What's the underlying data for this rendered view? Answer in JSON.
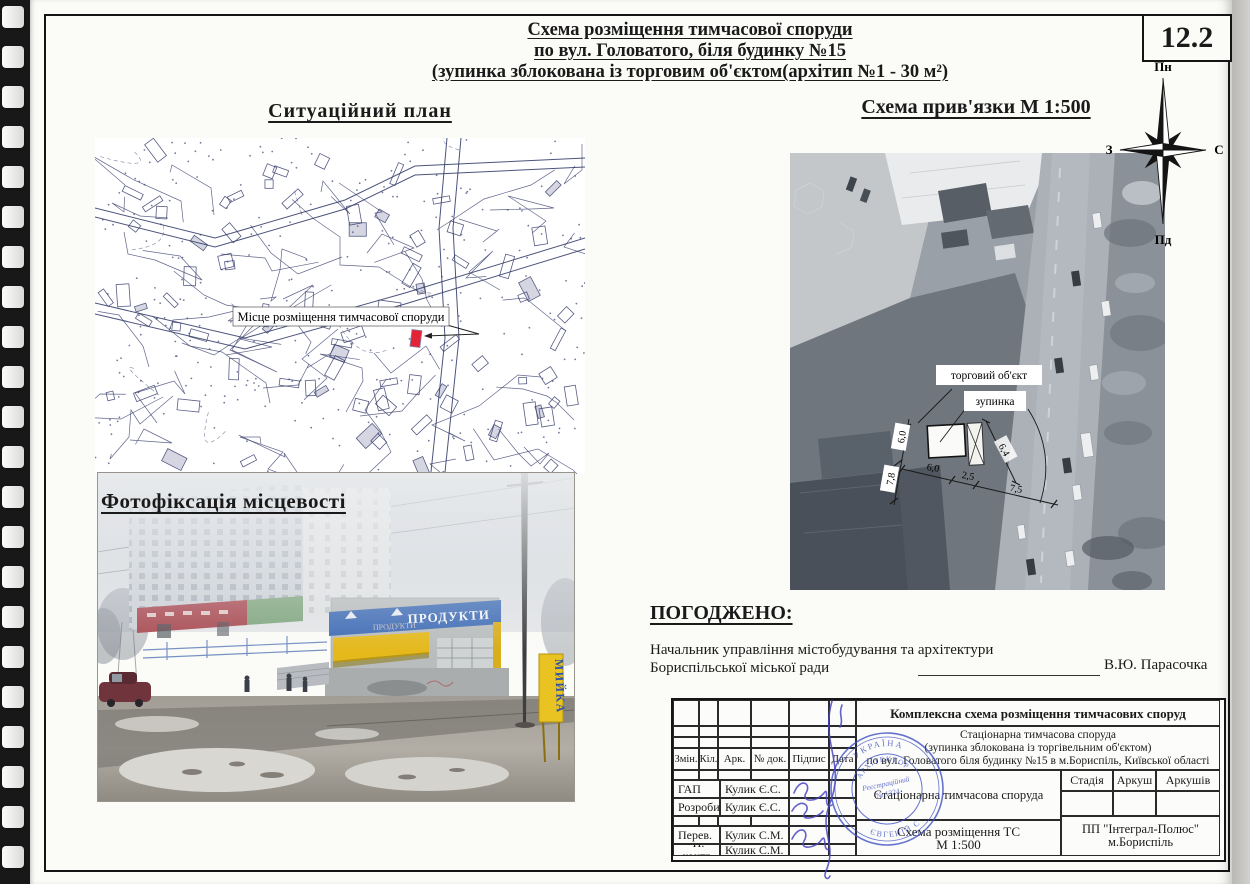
{
  "page": {
    "number": "12.2"
  },
  "header": {
    "title_lines": [
      "Схема розміщення тимчасової споруди",
      "по вул. Головатого, біля будинку №15",
      "(зупинка зблокована із торговим об'єктом(архітип №1 - 30 м²)"
    ]
  },
  "compass": {
    "n": "Пн",
    "s": "Пд",
    "w": "З",
    "e": "С"
  },
  "situational": {
    "heading": "Ситуаційний план",
    "marker_label": "Місце розміщення тимчасової споруди"
  },
  "layout_scheme": {
    "heading": "Схема прив'язки  М 1:500",
    "trade_object_label": "торговий об'єкт",
    "bus_stop_label": "зупинка",
    "dims": {
      "v1": "6,0",
      "v2": "7,8",
      "h1": "6,0",
      "h2": "2,5",
      "h3": "7,5",
      "d1": "6,4"
    }
  },
  "photo": {
    "heading": "Фотофіксація місцевості",
    "kiosk_sign": "ПРОДУКТИ",
    "wash_sign": "МИЙКА"
  },
  "approval": {
    "heading": "ПОГОДЖЕНО:",
    "line1": "Начальник управління містобудування та архітектури",
    "line2": "Бориспільської міської ради",
    "name": "В.Ю. Парасочка"
  },
  "title_block": {
    "project_title": "Комплексна схема розміщення тимчасових споруд",
    "object_line1": "Стаціонарна тимчасова споруда",
    "object_line2": "(зупинка зблокована із торгівельним об'єктом)",
    "object_line3": "по вул. Головатого біля будинку №15 в м.Бориспіль, Київської області",
    "col_zmin": "Змін.",
    "col_kil": "Кіл.",
    "col_ark": "Арк.",
    "col_ndok": "№ док.",
    "col_pidpys": "Підпис",
    "col_data": "Дата",
    "rows": [
      {
        "role": "ГАП",
        "name": "Кулик Є.С."
      },
      {
        "role": "Розробив",
        "name": "Кулик Є.С."
      },
      {
        "role": "Перев.",
        "name": "Кулик С.М."
      },
      {
        "role": "Н. контр.",
        "name": "Кулик С.М."
      }
    ],
    "doc_type": "Стаціонарна тимчасова споруда",
    "sheet_line1": "Схема розміщення ТС",
    "sheet_line2": "М 1:500",
    "stage": "Стадія",
    "sheet": "Аркуш",
    "sheets": "Аркушів",
    "company_line1": "ПП \"Інтеграл-Полюс\"",
    "company_line2": "м.Бориспіль",
    "stamp": {
      "top": "УКРАЇНА",
      "mid": "АРХІТЕКТОР",
      "reg1": "Реєстраційний",
      "reg2": "№ 1324",
      "bottom": "ЄВГЕНІЙ С"
    }
  }
}
